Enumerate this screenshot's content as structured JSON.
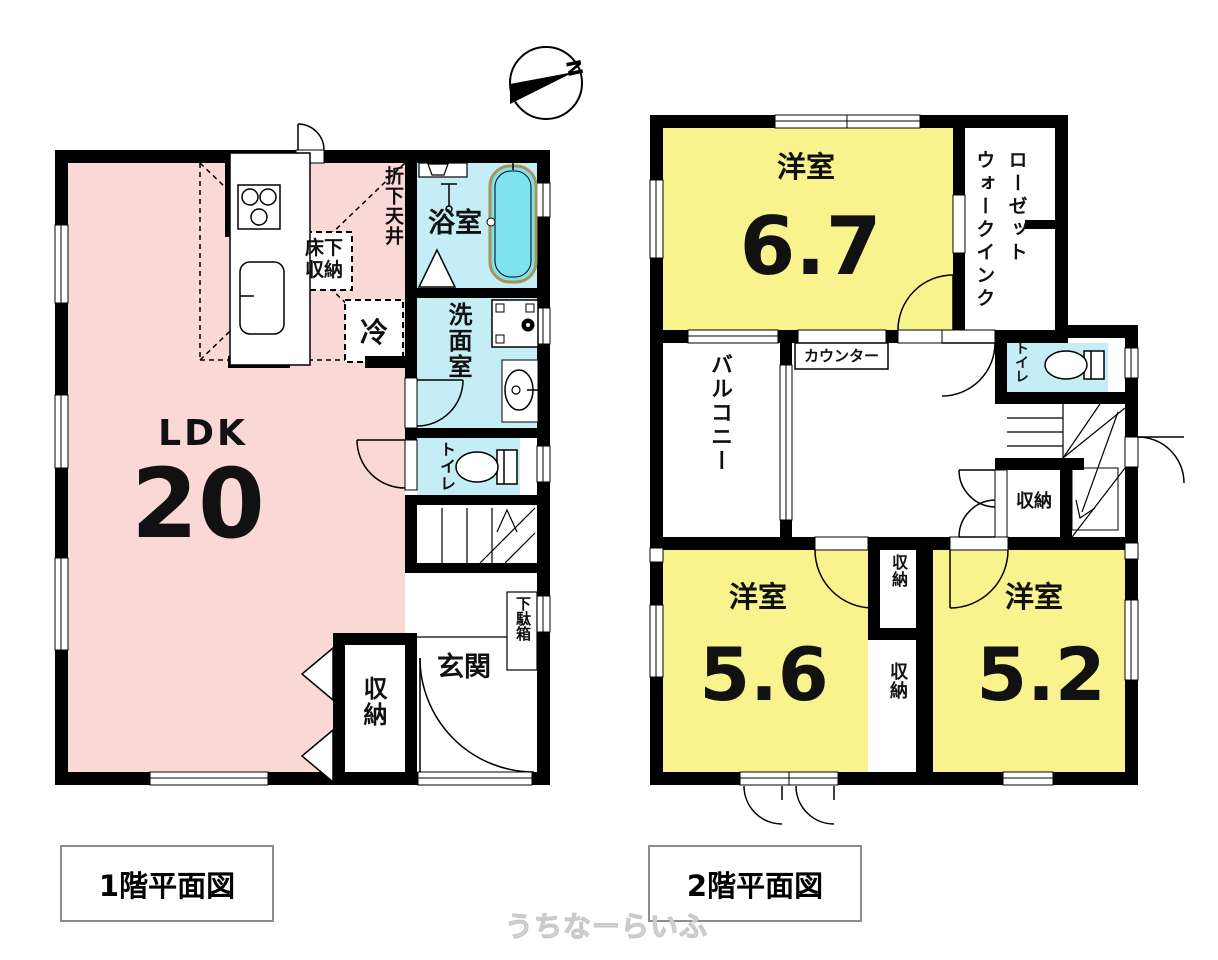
{
  "compass": {
    "north": "N"
  },
  "watermark": "うちなーらいふ",
  "colors": {
    "ldk_pink": "#f9d8d6",
    "room_yellow": "#f8f38c",
    "wet_blue": "#c4edf6",
    "tub_fill": "#7fe2ef",
    "tub_edge": "#a89457",
    "wall": "#000000",
    "caption_border": "#8c8c8c"
  },
  "floor1": {
    "caption": "1階平面図",
    "ldk": {
      "name": "LDK",
      "size": "20"
    },
    "bath": "浴室",
    "washroom": "洗面室",
    "toilet": "トイレ",
    "lowered_ceiling": "折下天井",
    "underfloor_storage": "床下収納",
    "fridge": "冷",
    "storage": "収納",
    "entrance": "玄関",
    "shoe_cabinet": "下駄箱"
  },
  "floor2": {
    "caption": "2階平面図",
    "room1": {
      "name": "洋室",
      "size": "6.7"
    },
    "walk_in_closet": "ウォークインクローゼット",
    "counter": "カウンター",
    "balcony": "バルコニー",
    "toilet": "トイレ",
    "storage_stairs": "収納",
    "storage_a": "収納",
    "storage_b": "収納",
    "room2": {
      "name": "洋室",
      "size": "5.6"
    },
    "room3": {
      "name": "洋室",
      "size": "5.2"
    }
  }
}
